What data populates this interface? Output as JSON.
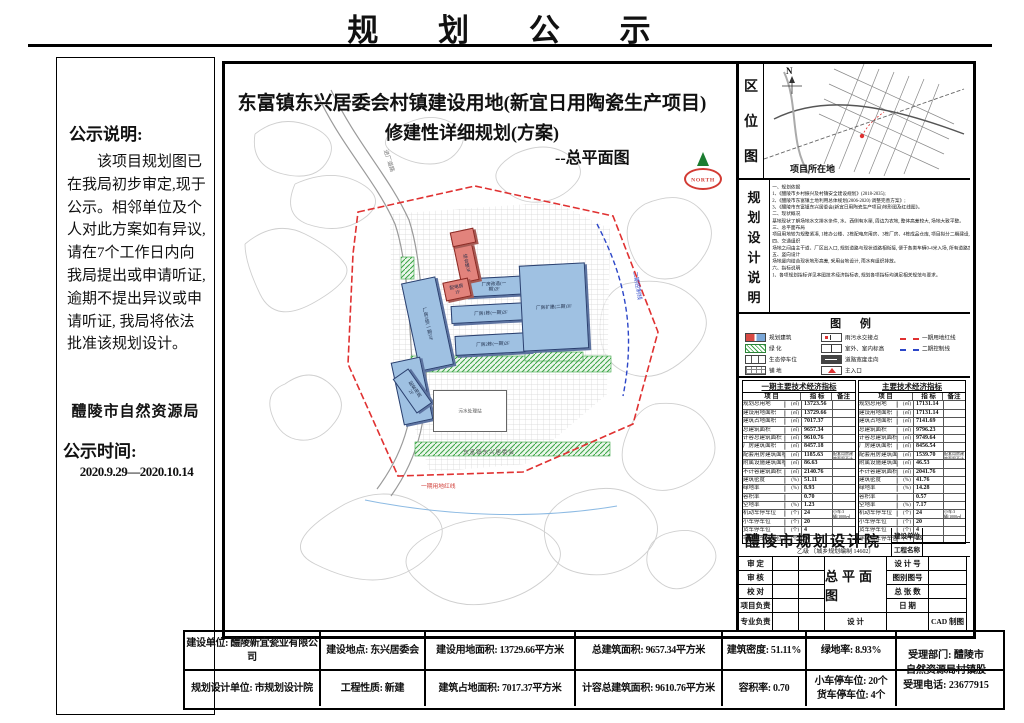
{
  "page": {
    "title": "规  划  公  示"
  },
  "sidebar": {
    "heading": "公示说明:",
    "body": "该项目规划图已在我局初步审定,现于公示。相邻单位及个人对此方案如有异议, 请在7个工作日内向我局提出或申请听证, 逾期不提出异议或申请听证, 我局将依法批准该规划设计。",
    "bureau": "醴陵市自然资源局",
    "period_label": "公示时间:",
    "period": "2020.9.29—2020.10.14"
  },
  "plan": {
    "title_line1": "东富镇东兴居委会村镇建设用地(新宜日用陶瓷生产项目)",
    "title_line2": "修建性详细规划(方案)",
    "subtitle": "--总平面图",
    "north_label": "NORTH",
    "buildings": {
      "b1": "厂房3栋(一期)3F",
      "b2": "厂房改造(一期)2F",
      "b3": "厂房1栋(一期)2F",
      "b4": "厂房2栋(一期)2F",
      "b5": "厂房扩建(二期)3F",
      "b6": "配套用房2F",
      "b7": "综合楼3F",
      "b8": "配电房1F",
      "b9": "污水处理站"
    },
    "labels": {
      "road": "进厂道路",
      "village": "东富镇东兴居委会",
      "boundary_phase1": "一期用地红线",
      "boundary_phase2": "二期控制线"
    }
  },
  "location_map": {
    "chars": [
      "区",
      "位",
      "图"
    ],
    "north": "N",
    "site_label": "项目所在地"
  },
  "design_notes": {
    "chars": [
      "规",
      "划",
      "设",
      "计",
      "说",
      "明"
    ],
    "lines": [
      "一、规划依据",
      "1、《醴陵市乡村振兴及村镇安全建设规划》(2018-2035);",
      "2、《醴陵市东富镇土地利用总体规划(2006-2020) 调整完善方案》;",
      "3、《醴陵市东富镇东兴居委会(新宜日用陶瓷生产项目)地形图及红线图》。",
      "二、现状概况",
      "基地现状了解场地水文排水条件, 水、西侧有水渠, 周边为农地, 整体高差较大, 场地大致平整。",
      "三、总平面布局",
      "项目用地较为规整紧凑, 1栋办公楼、2栋配电房用房、3栋厂房、4栋成品仓库, 项目拟分二期建设, 厂房东大侧为生产区, 办公区留有发展用地为二期。",
      "四、交通组织",
      "场地之间由主干道、厂区出入口, 规划道路与现状道路相衔接, 便于各类车辆0-4米入场, 所有道路宽度一定满足消防要求, 形成3个环形消防车道, 便于消防疏散。",
      "五、竖向设计",
      "场地竖向结合现状地形高差, 采用台地设计, 雨水有组织排放。",
      "六、指标说明",
      "1、各项规划指标详见本图技术经济指标表, 规划各项指标均满足相关规范与要求。"
    ]
  },
  "legend": {
    "title": "图  例",
    "items": [
      {
        "label": "规划建筑"
      },
      {
        "label": "绿  化"
      },
      {
        "label": "生态停车位"
      },
      {
        "label": "铺  地"
      },
      {
        "label": "雨污水交接点"
      },
      {
        "label": "室外、室内标高"
      },
      {
        "label": "道路宽度走向"
      },
      {
        "label": "主入口"
      },
      {
        "label": "一期用地红线"
      },
      {
        "label": "二期控制线"
      }
    ]
  },
  "tables": {
    "phase1": {
      "title": "一期主要技术经济指标",
      "h": [
        "项  目",
        "指 标",
        "备注"
      ],
      "rows": [
        {
          "n": "规划总用地",
          "u": "(㎡)",
          "v": "13723.56",
          "b": ""
        },
        {
          "n": "建设用地面积",
          "u": "(㎡)",
          "v": "13729.66",
          "b": ""
        },
        {
          "n": "建筑占地面积",
          "u": "(㎡)",
          "v": "7017.37",
          "b": ""
        },
        {
          "n": "总建筑面积",
          "u": "(㎡)",
          "v": "9657.34",
          "b": ""
        },
        {
          "n": "计容总建筑面积",
          "u": "(㎡)",
          "v": "9610.76",
          "b": ""
        },
        {
          "n": "厂房建筑面积",
          "u": "(㎡)",
          "v": "8457.18",
          "b": ""
        },
        {
          "n": "配套用房建筑面积",
          "u": "(㎡)",
          "v": "1185.63",
          "b": "配套用房建筑面积不计容"
        },
        {
          "n": "附属设施建筑面积",
          "u": "(㎡)",
          "v": "86.63",
          "b": ""
        },
        {
          "n": "不计容建筑面积",
          "u": "(㎡)",
          "v": "2140.76",
          "b": ""
        },
        {
          "n": "建筑密度",
          "u": "(%)",
          "v": "51.11",
          "b": ""
        },
        {
          "n": "绿地率",
          "u": "(%)",
          "v": "8.93",
          "b": ""
        },
        {
          "n": "容积率",
          "u": "",
          "v": "0.70",
          "b": ""
        },
        {
          "n": "空地率",
          "u": "(%)",
          "v": "1.23",
          "b": ""
        },
        {
          "n": "机动车停车位",
          "u": "(个)",
          "v": "24",
          "b": "小车:3辆/1000㎡ 货车:1辆/3000㎡"
        },
        {
          "n": "小车停车位",
          "u": "(个)",
          "v": "20",
          "b": ""
        },
        {
          "n": "货车停车位",
          "u": "(个)",
          "v": "4",
          "b": ""
        },
        {
          "n": "非机动车停车位",
          "u": "(个)",
          "v": "50",
          "b": ""
        }
      ]
    },
    "overall": {
      "title": "主要技术经济指标",
      "h": [
        "项  目",
        "指 标",
        "备注"
      ],
      "rows": [
        {
          "n": "规划总用地",
          "u": "(㎡)",
          "v": "17131.14",
          "b": ""
        },
        {
          "n": "建设用地面积",
          "u": "(㎡)",
          "v": "17131.14",
          "b": ""
        },
        {
          "n": "建筑占地面积",
          "u": "(㎡)",
          "v": "7141.69",
          "b": ""
        },
        {
          "n": "总建筑面积",
          "u": "(㎡)",
          "v": "9796.23",
          "b": ""
        },
        {
          "n": "计容总建筑面积",
          "u": "(㎡)",
          "v": "9749.64",
          "b": ""
        },
        {
          "n": "厂房建筑面积",
          "u": "(㎡)",
          "v": "8456.54",
          "b": ""
        },
        {
          "n": "配套用房建筑面积",
          "u": "(㎡)",
          "v": "1539.70",
          "b": "配套用房建筑面积不计容"
        },
        {
          "n": "附属设施建筑面积",
          "u": "(㎡)",
          "v": "46.53",
          "b": ""
        },
        {
          "n": "不计容建筑面积",
          "u": "(㎡)",
          "v": "2041.76",
          "b": ""
        },
        {
          "n": "建筑密度",
          "u": "(%)",
          "v": "41.76",
          "b": ""
        },
        {
          "n": "绿地率",
          "u": "(%)",
          "v": "14.28",
          "b": ""
        },
        {
          "n": "容积率",
          "u": "",
          "v": "0.57",
          "b": ""
        },
        {
          "n": "空地率",
          "u": "(%)",
          "v": "7.17",
          "b": ""
        },
        {
          "n": "机动车停车位",
          "u": "(个)",
          "v": "24",
          "b": "小车:3辆/1000㎡ 货车:1辆/3000㎡"
        },
        {
          "n": "小车停车位",
          "u": "(个)",
          "v": "20",
          "b": ""
        },
        {
          "n": "货车停车位",
          "u": "(个)",
          "v": "4",
          "b": ""
        },
        {
          "n": "非机动车停车位",
          "u": "(个)",
          "v": "23",
          "b": ""
        }
      ]
    }
  },
  "title_block": {
    "name": "醴陵市规划设计院",
    "grade": "乙级 〔城乡规划编制 14602〕",
    "owner_label": "建设单位",
    "project_label": "工程名称",
    "rows": [
      "审  定",
      "审  核",
      "校  对",
      "项目负责",
      "专业负责"
    ],
    "right_labels": [
      "设 计 号",
      "图别图号",
      "总 张 数",
      "日  期"
    ],
    "center": "总平面图",
    "design_label": "设  计",
    "cad_label": "CAD 制图"
  },
  "bottom_table": {
    "row1": [
      "建设单位: 醴陵新宜瓷业有限公司",
      "建设地点: 东兴居委会",
      "建设用地面积: 13729.66平方米",
      "总建筑面积: 9657.34平方米",
      "建筑密度: 51.11%",
      "绿地率: 8.93%"
    ],
    "row2": [
      "规划设计单位: 市规划设计院",
      "工程性质: 新建",
      "建筑占地面积: 7017.37平方米",
      "计容总建筑面积: 9610.76平方米",
      "容积率: 0.70",
      "小车停车位: 20个\n货车停车位: 4个"
    ],
    "accept": "受理部门: 醴陵市\n自然资源局村镇股\n受理电话: 23677915"
  }
}
